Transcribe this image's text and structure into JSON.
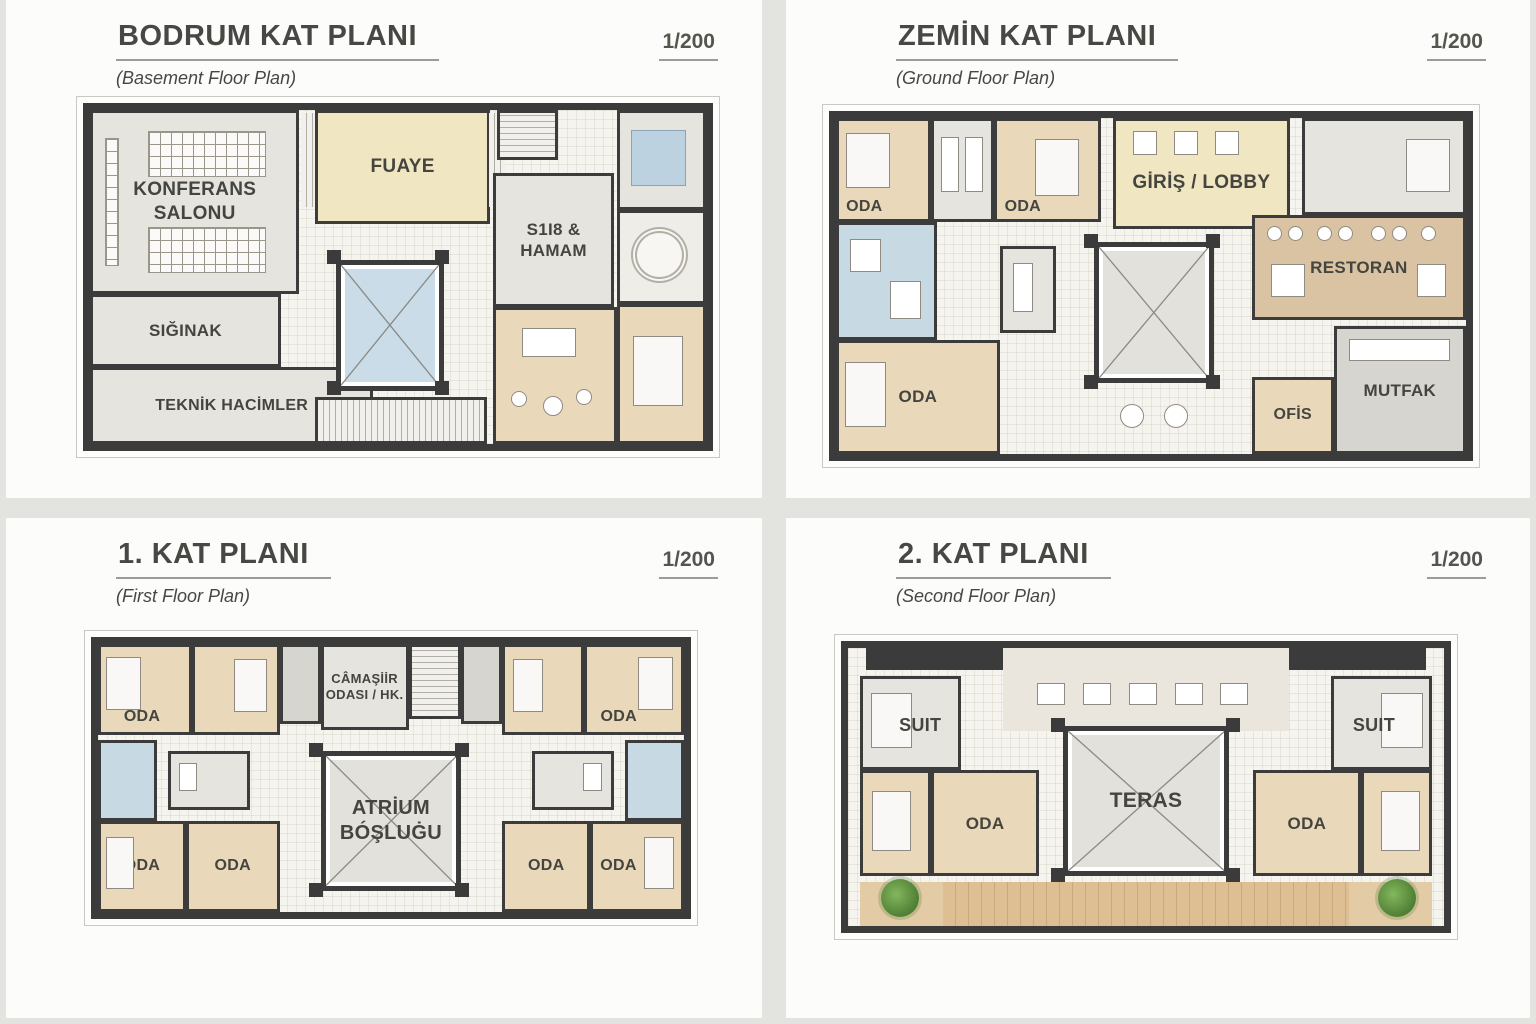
{
  "panels": [
    {
      "title": "BODRUM KAT PLANI",
      "subtitle": "(Basement Floor Plan)",
      "scale": "1/200",
      "rooms": {
        "konferans": "KONFERANS\nSALONU",
        "fuaye": "FUAYE",
        "spa": "S1I8 &\nHAMAM",
        "siginak": "SIĞINAK",
        "teknik": "TEKNİK HACİMLER"
      }
    },
    {
      "title": "ZEMİN KAT PLANI",
      "subtitle": "(Ground Floor Plan)",
      "scale": "1/200",
      "rooms": {
        "oda1": "ODA",
        "oda2": "ODA",
        "lobby": "GİRİŞ / LOBBY",
        "restoran": "RESTORAN",
        "oda3": "ODA",
        "ofis": "OFİS",
        "mutfak": "MUTFAK"
      }
    },
    {
      "title": "1. KAT PLANI",
      "subtitle": "(First Floor Plan)",
      "scale": "1/200",
      "rooms": {
        "oda_tl": "ODA",
        "laundry": "CÂMAŞİİR\nODASI / HK.",
        "oda_tr": "ODA",
        "atrium": "ATRİUM\nBÓŞLUĠU",
        "oda_bl1": "ODA",
        "oda_bl2": "ODA",
        "oda_br1": "ODA",
        "oda_br2": "ODA"
      }
    },
    {
      "title": "2. KAT PLANI",
      "subtitle": "(Second Floor Plan)",
      "scale": "1/200",
      "rooms": {
        "suit_l": "SUIT",
        "suit_r": "SUIT",
        "oda_l": "ODA",
        "teras": "TERAS",
        "oda_r": "ODA"
      }
    }
  ],
  "colors": {
    "page_background": "#e3e3e0",
    "panel_background": "#fcfcfb",
    "wall": "#3b3b3b",
    "room_tan": "#ead8ba",
    "room_cream": "#f1e6c2",
    "room_gray": "#e6e4df",
    "water_blue": "#c9dce8",
    "restaurant_tan": "#d9c3a2",
    "deck_wood": "#ddbf93",
    "plant_green": "#4e7d33",
    "text": "#474743"
  }
}
